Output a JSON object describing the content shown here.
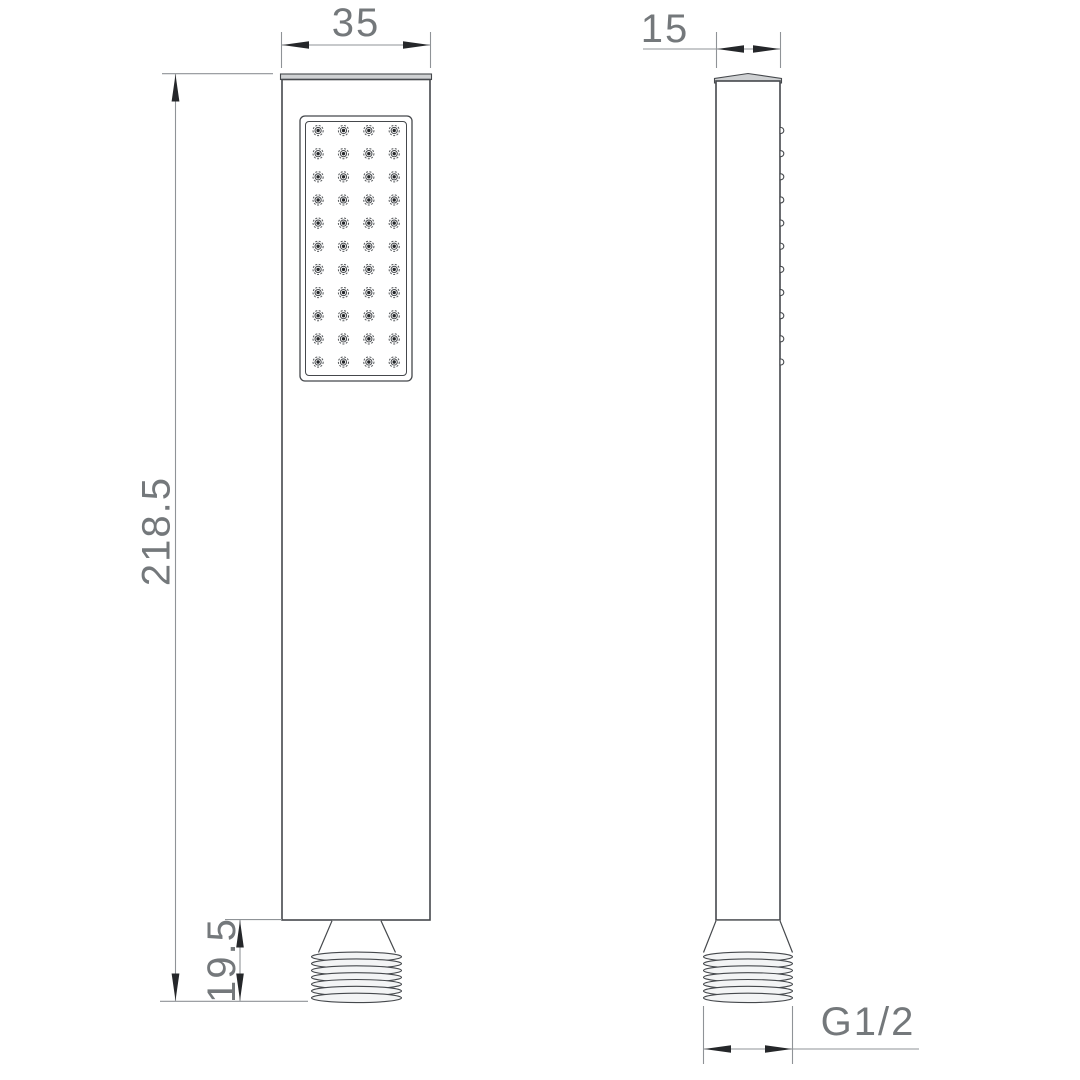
{
  "drawing": {
    "type": "technical-drawing",
    "subject": "handheld-shower-two-view",
    "dimensions": {
      "width_label": "35",
      "depth_label": "15",
      "height_label": "218.5",
      "inlet_length_label": "19.5",
      "thread_label": "G1/2"
    },
    "spray_face": {
      "nozzle_rows": 11,
      "nozzle_columns": 4
    },
    "thread": {
      "ridge_count": 7
    },
    "colors": {
      "object_line": "#45484c",
      "dimension_line": "#8f9397",
      "arrow": "#25272a",
      "label_text": "#74787b",
      "cap_fill": "#cfd1d3",
      "thread_fill": "#f3f4f5",
      "nozzle_ring": "#55585b",
      "background": "#ffffff"
    }
  }
}
